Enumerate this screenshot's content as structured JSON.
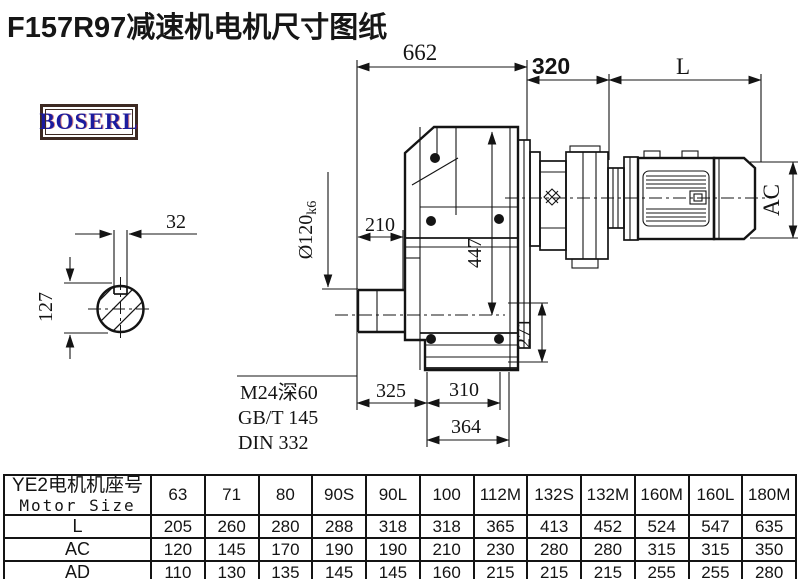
{
  "title": "F157R97减速机电机尺寸图纸",
  "logo": {
    "text": "BOSERL"
  },
  "drawing": {
    "dim_662": "662",
    "dim_320": "320",
    "dim_L": "L",
    "dim_AC": "AC",
    "dim_32": "32",
    "dim_127": "127",
    "dim_210": "210",
    "dim_447": "447",
    "dim_271": "271",
    "dim_325": "325",
    "dim_310": "310",
    "dim_364": "364",
    "shaft_dim": {
      "main": "Ø120",
      "tolerance": "k6"
    },
    "callout": {
      "line1": "M24深60",
      "line2": "GB/T 145",
      "line3": "DIN 332"
    }
  },
  "table": {
    "header": {
      "cn": "YE2电机机座号",
      "en": "Motor Size"
    },
    "columns": [
      "63",
      "71",
      "80",
      "90S",
      "90L",
      "100",
      "112M",
      "132S",
      "132M",
      "160M",
      "160L",
      "180M"
    ],
    "rows": [
      {
        "label": "L",
        "values": [
          "205",
          "260",
          "280",
          "288",
          "318",
          "318",
          "365",
          "413",
          "452",
          "524",
          "547",
          "635"
        ]
      },
      {
        "label": "AC",
        "values": [
          "120",
          "145",
          "170",
          "190",
          "190",
          "210",
          "230",
          "280",
          "280",
          "315",
          "315",
          "350"
        ]
      },
      {
        "label": "AD",
        "values": [
          "110",
          "130",
          "135",
          "145",
          "145",
          "160",
          "215",
          "215",
          "215",
          "255",
          "255",
          "280"
        ]
      }
    ]
  },
  "colors": {
    "line": "#141414",
    "logo_text": "#1c1c9e",
    "logo_border": "#3d2a23"
  }
}
